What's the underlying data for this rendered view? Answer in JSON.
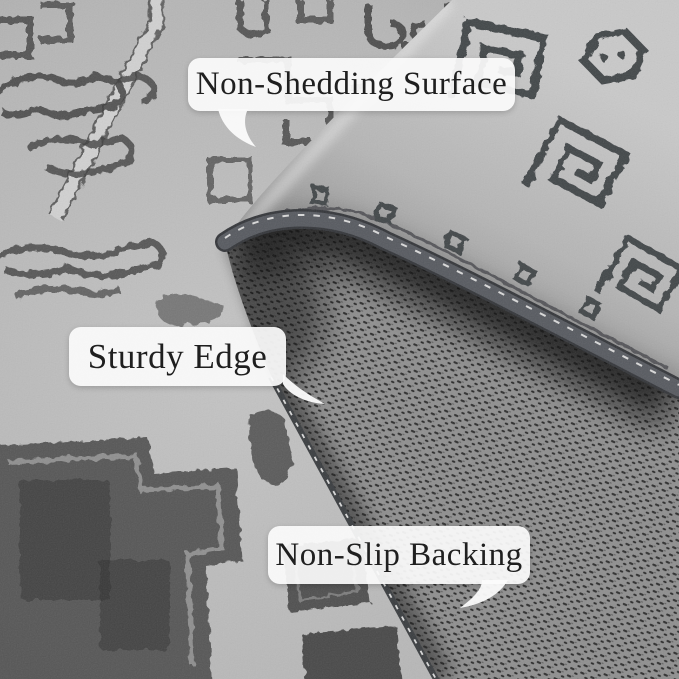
{
  "callouts": [
    {
      "id": "non-shedding-surface",
      "label": "Non-Shedding Surface"
    },
    {
      "id": "sturdy-edge",
      "label": "Sturdy Edge"
    },
    {
      "id": "non-slip-backing",
      "label": "Non-Slip Backing"
    }
  ],
  "colors": {
    "rug_surface": "#b7b7b7",
    "rug_motif": "#3e3e3e",
    "fold_highlight": "#efefef",
    "binding": "#575a60",
    "stitch": "#d9d9d9",
    "fold_shadow": "#0c0c0c",
    "backing": "#8f8f8f",
    "backing_mark": "#2d2d2d",
    "bubble_bg": "#fbfbfb",
    "bubble_text": "#1f1f1f"
  }
}
